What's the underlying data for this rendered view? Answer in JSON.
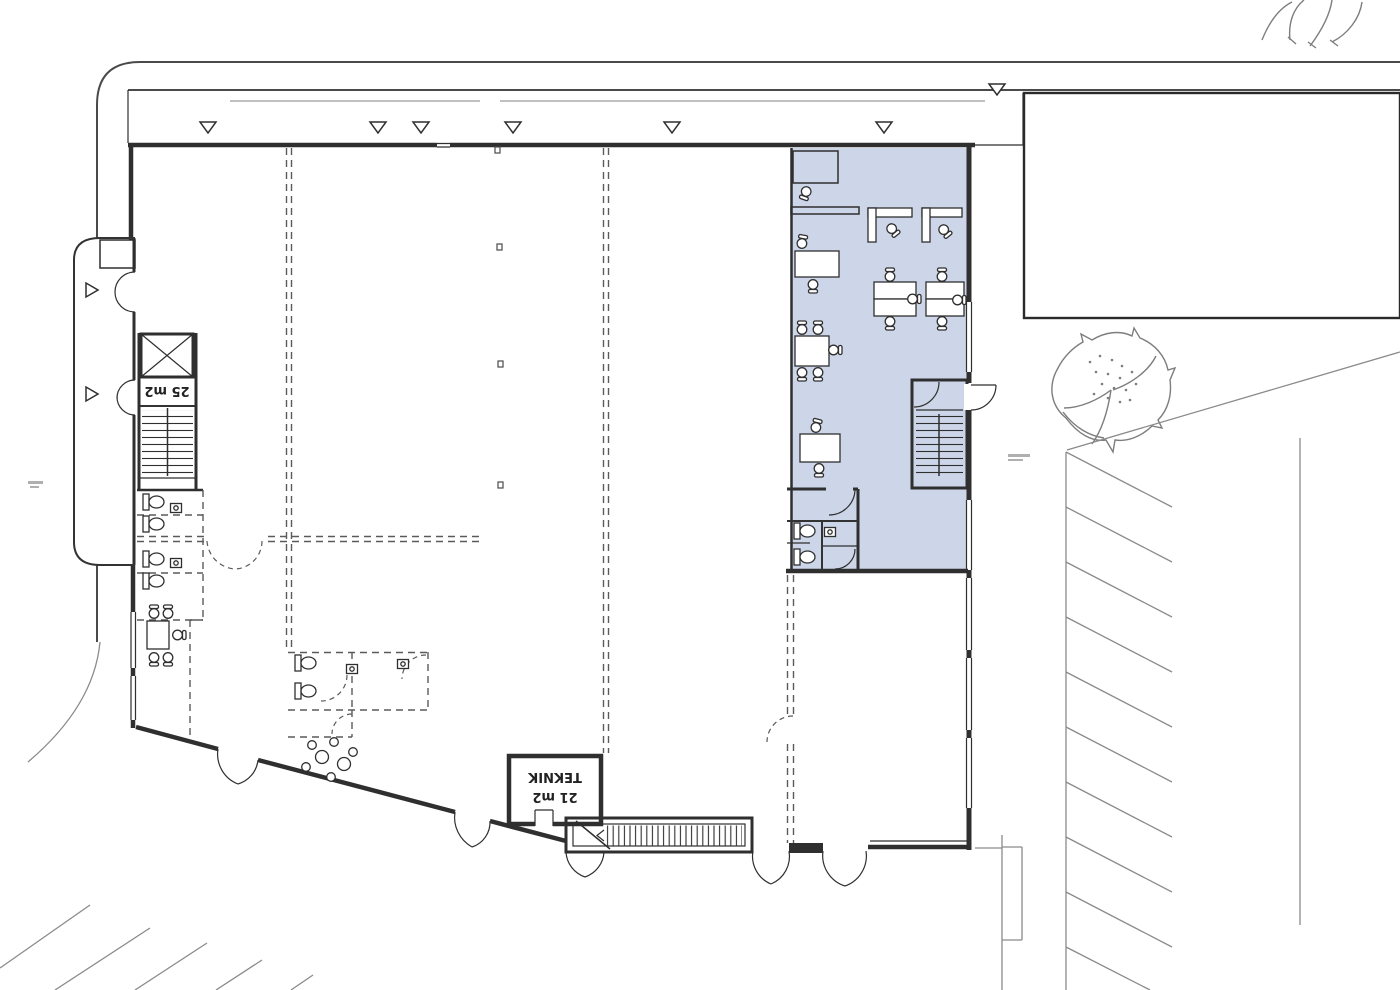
{
  "document": {
    "type": "architectural-floor-plan",
    "view": "ground-floor plan with site surroundings"
  },
  "labels": {
    "stair_core_area": "25 m2",
    "teknik_name": "TEKNIK",
    "teknik_area": "21 m2"
  },
  "colors": {
    "highlight_fill": "#ccd6e8",
    "wall": "#2f2f2f",
    "site_line": "#4a4a4a",
    "vegetation_line": "#7d7d7d",
    "background": "#ffffff"
  },
  "zones": {
    "highlighted_office": {
      "description_color": "#ccd6e8"
    }
  }
}
